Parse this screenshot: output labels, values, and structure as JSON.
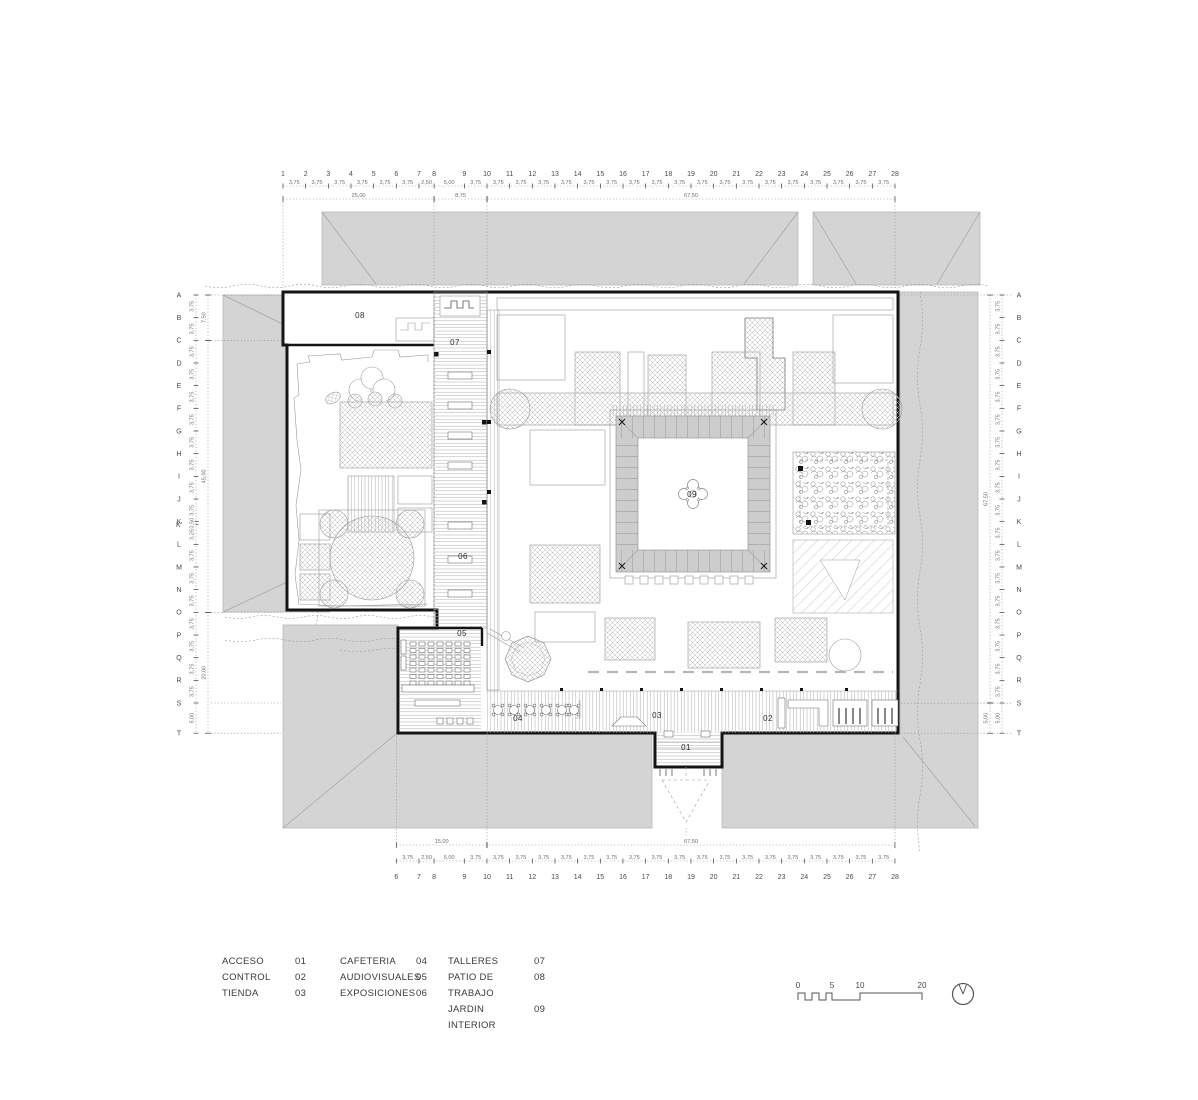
{
  "sheet": {
    "kind": "architectural floor plan"
  },
  "rooms": [
    {
      "id": "01",
      "x": 686,
      "y": 750
    },
    {
      "id": "02",
      "x": 768,
      "y": 721
    },
    {
      "id": "03",
      "x": 657,
      "y": 718
    },
    {
      "id": "04",
      "x": 518,
      "y": 721
    },
    {
      "id": "05",
      "x": 462,
      "y": 636
    },
    {
      "id": "06",
      "x": 463,
      "y": 559
    },
    {
      "id": "07",
      "x": 455,
      "y": 345
    },
    {
      "id": "08",
      "x": 360,
      "y": 318
    },
    {
      "id": "09",
      "x": 692,
      "y": 497
    }
  ],
  "legend": {
    "columns": [
      {
        "left": 222,
        "label_w": 73,
        "entries": [
          {
            "label": "ACCESO",
            "num": "01"
          },
          {
            "label": "CONTROL",
            "num": "02"
          },
          {
            "label": "TIENDA",
            "num": "03"
          }
        ]
      },
      {
        "left": 340,
        "label_w": 76,
        "entries": [
          {
            "label": "CAFETERIA",
            "num": "04"
          },
          {
            "label": "AUDIOVISUALES",
            "num": "05"
          },
          {
            "label": "EXPOSICIONES",
            "num": "06"
          }
        ]
      },
      {
        "left": 448,
        "label_w": 86,
        "entries": [
          {
            "label": "TALLERES",
            "num": "07"
          },
          {
            "label": "PATIO DE TRABAJO",
            "num": "08"
          },
          {
            "label": "JARDIN INTERIOR",
            "num": "09"
          }
        ]
      }
    ]
  },
  "scalebar": {
    "labels": [
      {
        "text": "0",
        "x": 798
      },
      {
        "text": "5",
        "x": 832
      },
      {
        "text": "10",
        "x": 860
      },
      {
        "text": "20",
        "x": 922
      }
    ]
  },
  "grid_top": {
    "x0": 283,
    "numbers": [
      "1",
      "2",
      "3",
      "4",
      "5",
      "6",
      "7",
      "8",
      "9",
      "10",
      "11",
      "12",
      "13",
      "14",
      "15",
      "16",
      "17",
      "18",
      "19",
      "20",
      "21",
      "22",
      "23",
      "24",
      "25",
      "26",
      "27",
      "28"
    ],
    "gaps": [
      "3,75",
      "3,75",
      "3,75",
      "3,75",
      "3,75",
      "3,75",
      "2,50",
      "5,00",
      "3,75",
      "3,75",
      "3,75",
      "3,75",
      "3,75",
      "3,75",
      "3,75",
      "3,75",
      "3,75",
      "3,75",
      "3,75",
      "3,75",
      "3,75",
      "3,75",
      "3,75",
      "3,75",
      "3,75",
      "3,75",
      "3,75"
    ],
    "large": [
      {
        "label": "25,00",
        "from": 0,
        "to": 7
      },
      {
        "label": "8,75",
        "from": 7,
        "to": 9
      },
      {
        "label": "67,50",
        "from": 9,
        "to": 27
      }
    ]
  },
  "grid_bottom": {
    "x0": 396.3,
    "numbers": [
      "6",
      "7",
      "8",
      "9",
      "10",
      "11",
      "12",
      "13",
      "14",
      "15",
      "16",
      "17",
      "18",
      "19",
      "20",
      "21",
      "22",
      "23",
      "24",
      "25",
      "26",
      "27",
      "28"
    ],
    "gaps": [
      "3,75",
      "2,50",
      "5,00",
      "3,75",
      "3,75",
      "3,75",
      "3,75",
      "3,75",
      "3,75",
      "3,75",
      "3,75",
      "3,75",
      "3,75",
      "3,75",
      "3,75",
      "3,75",
      "3,75",
      "3,75",
      "3,75",
      "3,75",
      "3,75",
      "3,75"
    ],
    "large": [
      {
        "label": "15,00",
        "from": 0,
        "to": 4
      },
      {
        "label": "67,50",
        "from": 4,
        "to": 22
      }
    ]
  },
  "grid_left": {
    "y0": 295,
    "letters": [
      "A",
      "B",
      "C",
      "D",
      "E",
      "F",
      "G",
      "H",
      "I",
      "J",
      "K",
      "K'",
      "L",
      "M",
      "N",
      "O",
      "P",
      "Q",
      "R",
      "S",
      "T"
    ],
    "gaps": [
      "3,75",
      "3,75",
      "3,75",
      "3,75",
      "3,75",
      "3,75",
      "3,75",
      "3,75",
      "3,75",
      "3,75",
      "0,50",
      "3,25",
      "3,75",
      "3,75",
      "3,75",
      "3,75",
      "3,75",
      "3,75",
      "3,75",
      "5,00"
    ],
    "large": [
      {
        "label": "7,50",
        "from": 0,
        "to": 2
      },
      {
        "label": "45,00",
        "from": 2,
        "to": 15
      },
      {
        "label": "20,00",
        "from": 15,
        "to": 20
      }
    ]
  },
  "grid_right": {
    "y0": 295,
    "letters": [
      "A",
      "B",
      "C",
      "D",
      "E",
      "F",
      "G",
      "H",
      "I",
      "J",
      "K",
      "L",
      "M",
      "N",
      "O",
      "P",
      "Q",
      "R",
      "S",
      "T"
    ],
    "gaps": [
      "3,75",
      "3,75",
      "3,75",
      "3,75",
      "3,75",
      "3,75",
      "3,75",
      "3,75",
      "3,75",
      "3,75",
      "3,75",
      "3,75",
      "3,75",
      "3,75",
      "3,75",
      "3,75",
      "3,75",
      "3,75",
      "5,00"
    ],
    "large": [
      {
        "label": "67,50",
        "from": 0,
        "to": 18
      },
      {
        "label": "5,00",
        "from": 18,
        "to": 19
      }
    ]
  },
  "colors": {
    "roof": "#d4d4d4",
    "wall": "#141414",
    "hatch": "#b8b8b8",
    "courtyard_band": "#cdcdcd"
  }
}
